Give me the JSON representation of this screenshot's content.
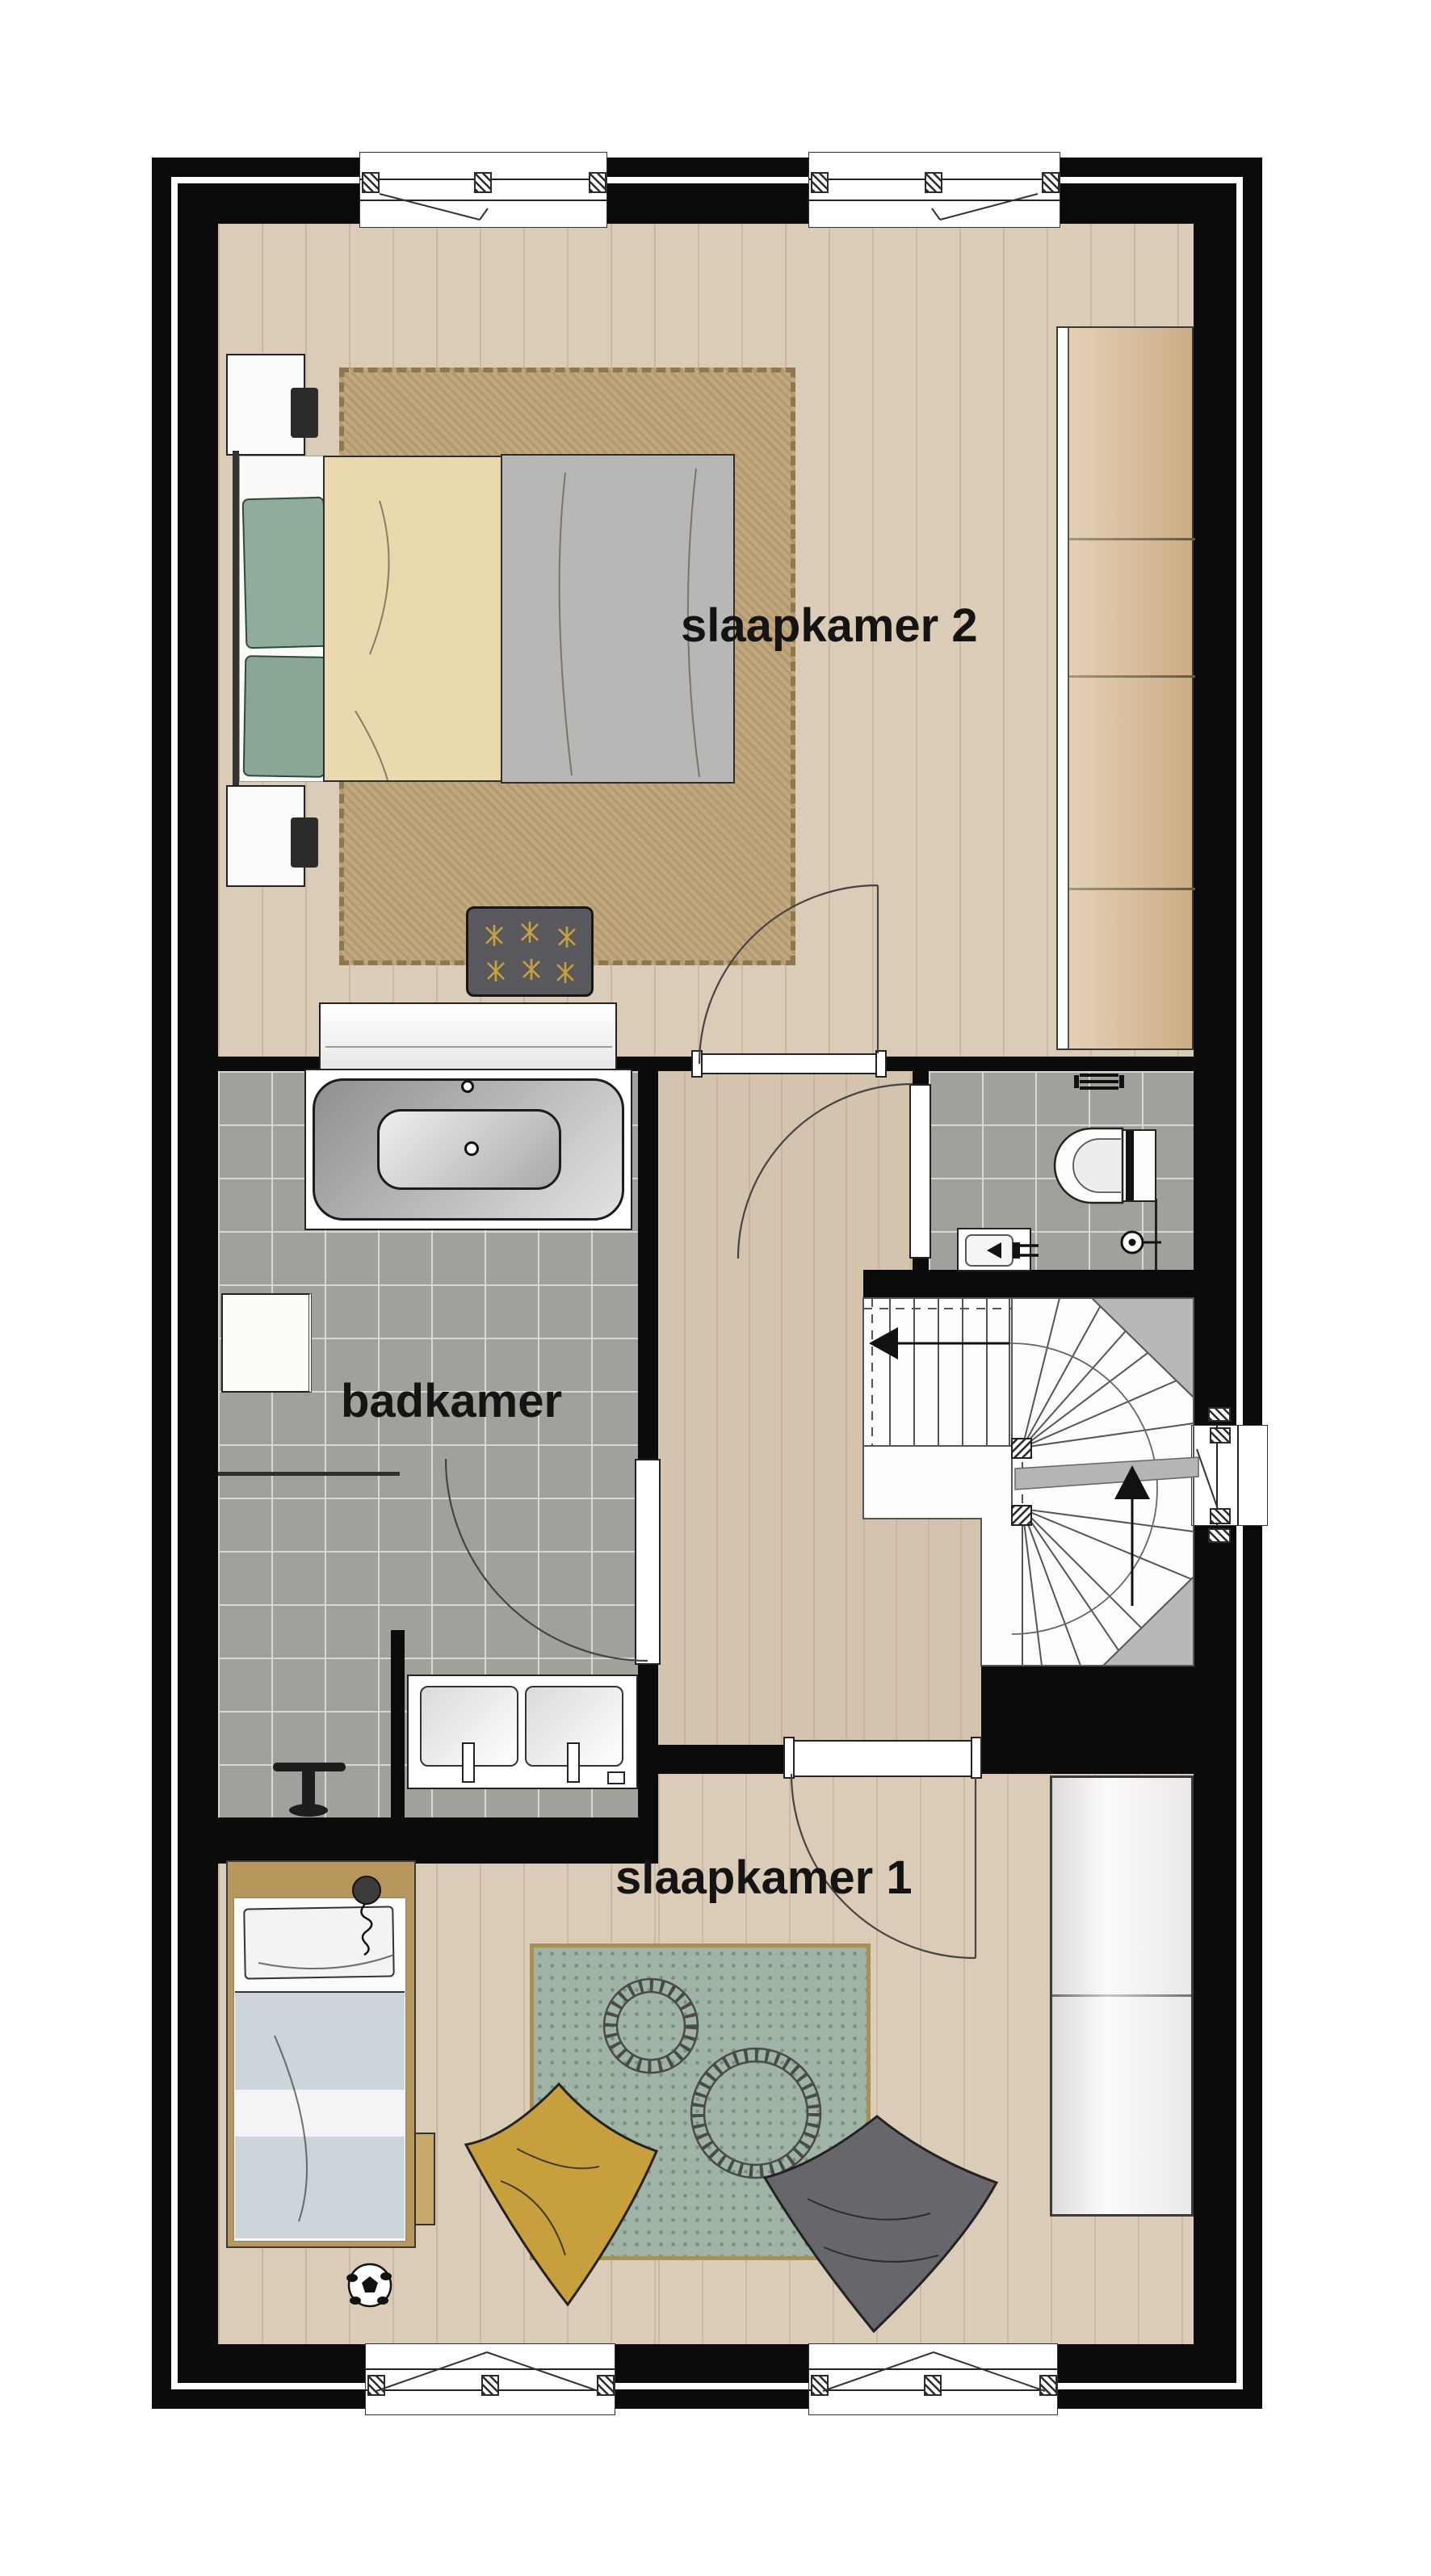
{
  "drawing": {
    "kind": "residential-floor-plan",
    "floor": "upper storey",
    "background": "#ffffff"
  },
  "palette": {
    "wall": "#0b0b0b",
    "wood_floor": "#dbccb7",
    "tile_floor": "#a1a19b",
    "rug_tan": "#c0a77e",
    "rug_green": "#9fb4a4",
    "bed_frame_gold": "#b6965a",
    "duvet_grey": "#b7b7b5",
    "blanket_cream": "#ead9ae",
    "pillow_green": "#90ad9c",
    "pillow_yellow": "#c79f3d",
    "pillow_grey": "#66666a",
    "ottoman_grey": "#59595d",
    "stair_accent_grey": "#b8b8b6"
  },
  "rooms": {
    "slaapkamer2": {
      "label": "slaapkamer 2",
      "floor": "wood",
      "fixtures": [
        "double-bed",
        "green-pillows",
        "cream-blanket",
        "grey-duvet",
        "nightstand",
        "table-lamp",
        "area-rug",
        "wardrobe",
        "sideboard",
        "tufted-ottoman",
        "window",
        "window",
        "swing-door"
      ]
    },
    "badkamer": {
      "label": "badkamer",
      "floor": "tile",
      "fixtures": [
        "bathtub",
        "cabinet",
        "shower-screen",
        "towel-stool",
        "double-vanity",
        "partition-wall",
        "swing-door"
      ]
    },
    "wc": {
      "label": "",
      "floor": "tile",
      "fixtures": [
        "toilet",
        "radiator",
        "hand-basin",
        "shut-off-valve",
        "swing-door"
      ]
    },
    "hal": {
      "label": "",
      "floor": "wood",
      "fixtures": [
        "winder-staircase",
        "stair-window"
      ]
    },
    "slaapkamer1": {
      "label": "slaapkamer 1",
      "floor": "wood",
      "fixtures": [
        "single-bed",
        "headboard-lamp",
        "bed-drawer",
        "play-rug",
        "toy-train-track",
        "yellow-pillow",
        "grey-pillow",
        "soccer-ball",
        "wardrobe",
        "window",
        "window",
        "swing-door"
      ]
    }
  },
  "stairs": {
    "type": "winder",
    "arrow_up": "up-direction",
    "arrow_left": "landing-direction"
  },
  "counts": {
    "windows": 5,
    "interior_doors": 4,
    "rooms_labelled": 3
  }
}
